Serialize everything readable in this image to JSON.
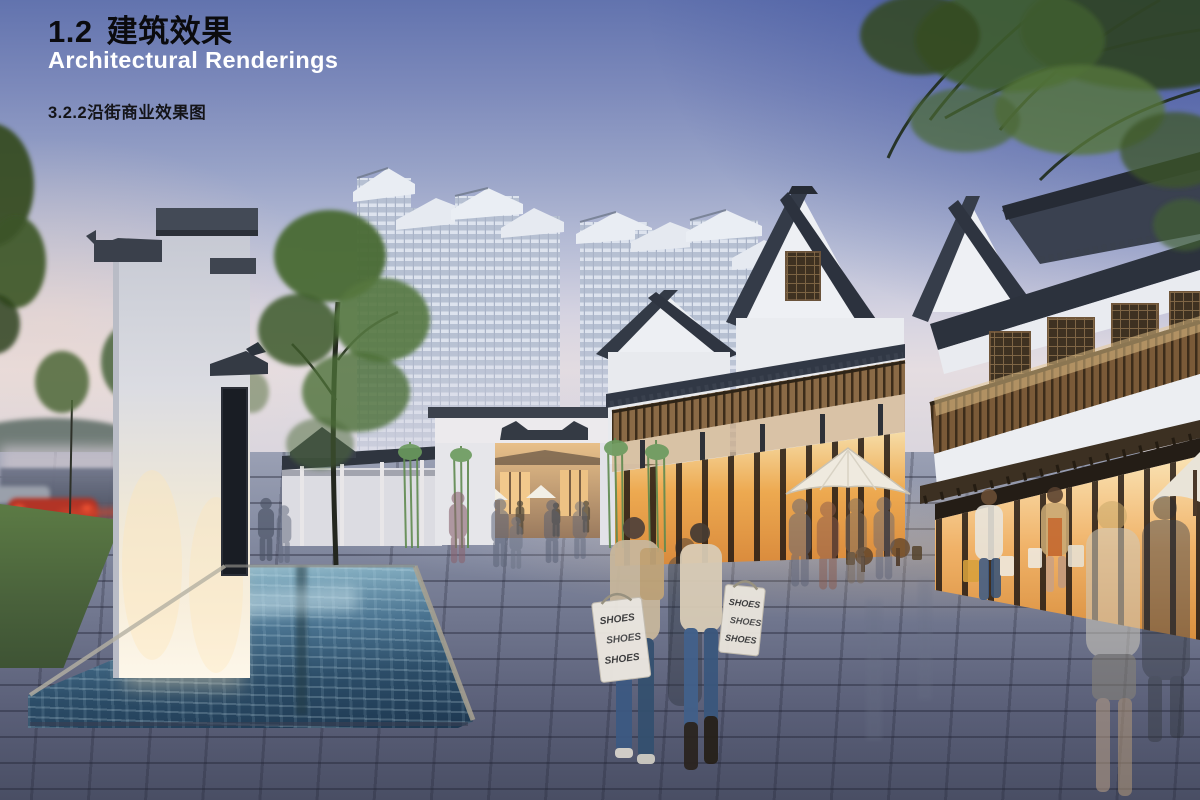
{
  "page": {
    "title_number": "1.2",
    "title_zh": "建筑效果",
    "subtitle_en": "Architectural Renderings",
    "caption": "3.2.2沿街商业效果图"
  },
  "figure": {
    "alt": "Dusk rendering of a traditional Chinese-style shopping street: white screen wall and reflecting pool on the left, white-and-dark-roofed shop buildings with glowing storefronts on the right, high-rise towers behind, pedestrians with shopping bags on a stone plaza",
    "bag_text": "SHOES",
    "colors": {
      "title_text": "#0b0b0e",
      "subtitle_text": "#ffffff",
      "caption_text": "#141418",
      "sky_top": "#5f6fae",
      "sky_deep_blue": "#3e53a2",
      "sky_horizon": "#e5dde1",
      "roof_slate": "#343b48",
      "wall_white": "#eef0f4",
      "timber_brown": "#7a5a38",
      "shop_glow": "#eda950",
      "water_deep": "#1d3750",
      "water_light": "#9fc6d8",
      "paving_gray": "#6b7189",
      "grass_green": "#5c7b45",
      "foliage_green": "#4a6a33"
    }
  }
}
